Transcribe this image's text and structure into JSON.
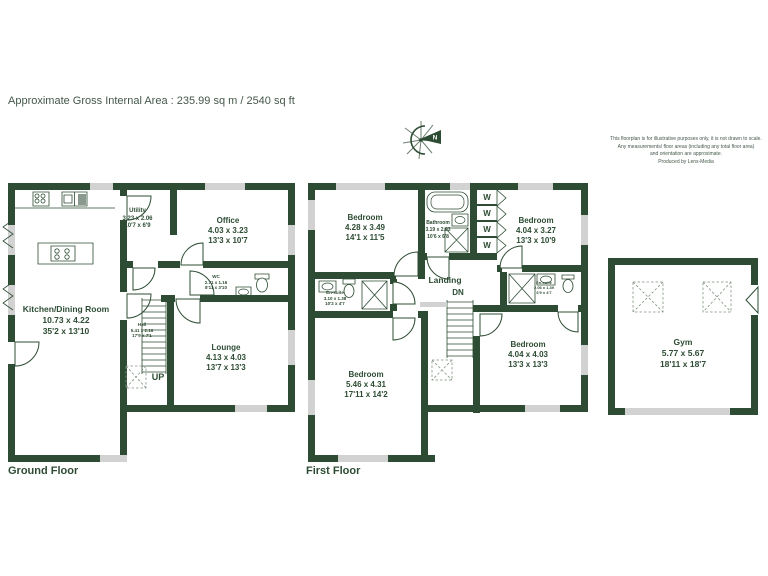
{
  "header": {
    "area_text": "Approximate Gross Internal Area : 235.99 sq m / 2540 sq ft"
  },
  "compass": {
    "label": "N"
  },
  "disclaimer": {
    "line1": "This floorplan is for illustrative purposes only, it is not drawn to scale.",
    "line2": "Any measurements/ floor areas (including any total floor area)",
    "line3": "and orientation are approximate.",
    "line4": "Produced by Lens-Media"
  },
  "colors": {
    "wall": "#2d4c33",
    "window": "#d2d2d2",
    "text": "#2d4c33"
  },
  "floors": {
    "ground": {
      "label": "Ground Floor",
      "stairs_label": "UP",
      "rooms": {
        "kitchen": {
          "name": "Kitchen/Dining Room",
          "metric": "10.73 x 4.22",
          "imperial": "35'2 x 13'10"
        },
        "utility": {
          "name": "Utility",
          "metric": "3.23 x 2.06",
          "imperial": "10'7 x 6'9"
        },
        "office": {
          "name": "Office",
          "metric": "4.03 x 3.23",
          "imperial": "13'3 x 10'7"
        },
        "wc": {
          "name": "WC",
          "metric": "2.71 x 1.16",
          "imperial": "8'11 x 3'10"
        },
        "hall": {
          "name": "Hall",
          "metric": "5.41 x 2.16",
          "imperial": "17'9 x 7'1"
        },
        "lounge": {
          "name": "Lounge",
          "metric": "4.13 x 4.03",
          "imperial": "13'7 x 13'3"
        }
      }
    },
    "first": {
      "label": "First Floor",
      "stairs_label": "DN",
      "wardrobe_label": "W",
      "rooms": {
        "bedroom_front": {
          "name": "Bedroom",
          "metric": "4.28 x 3.49",
          "imperial": "14'1 x 11'5"
        },
        "bathroom": {
          "name": "Bathroom",
          "metric": "3.19 x 2.03",
          "imperial": "10'6 x 6'8"
        },
        "bedroom_right": {
          "name": "Bedroom",
          "metric": "4.04 x 3.27",
          "imperial": "13'3 x 10'9"
        },
        "ensuite_main": {
          "name": "En-suite",
          "metric": "3.10 x 1.38",
          "imperial": "10'2 x 4'7"
        },
        "landing": {
          "name": "Landing"
        },
        "bedroom_main": {
          "name": "Bedroom",
          "metric": "5.46 x 4.31",
          "imperial": "17'11 x 14'2"
        },
        "ensuite_second": {
          "name": "En-suite",
          "metric": "2.06 x 1.39",
          "imperial": "6'9 x 4'7"
        },
        "bedroom_back": {
          "name": "Bedroom",
          "metric": "4.04 x 4.03",
          "imperial": "13'3 x 13'3"
        }
      }
    },
    "annexe": {
      "rooms": {
        "gym": {
          "name": "Gym",
          "metric": "5.77 x 5.67",
          "imperial": "18'11 x 18'7"
        }
      }
    }
  }
}
